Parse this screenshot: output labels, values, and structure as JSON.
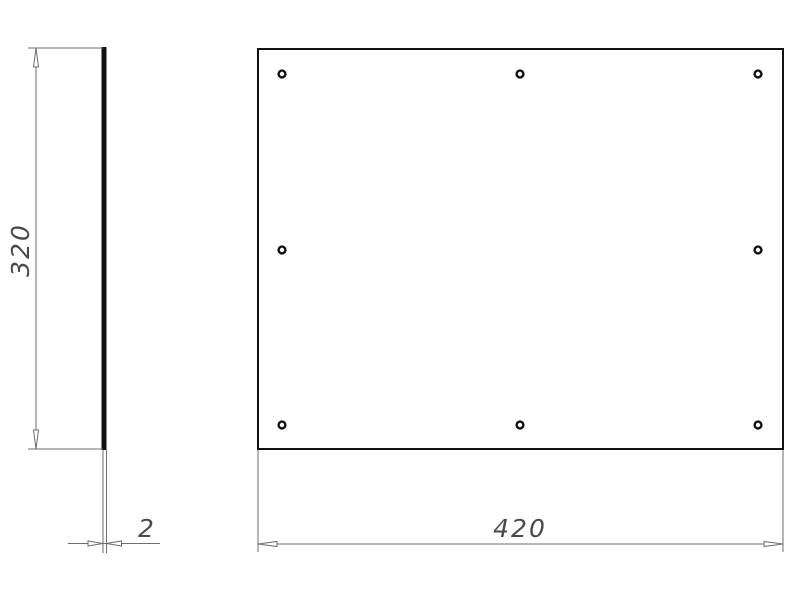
{
  "colors": {
    "background": "#ffffff",
    "outline": "#111111",
    "dim": "#6e6e6e",
    "text": "#4a4a4a"
  },
  "labels": {
    "plate_height": "320",
    "plate_thickness": "2",
    "plate_width": "420"
  },
  "front_view": {
    "hole_count": 8,
    "hole_radius": 3.4,
    "holes": [
      {
        "cx": 282,
        "cy": 74
      },
      {
        "cx": 520,
        "cy": 74
      },
      {
        "cx": 758,
        "cy": 74
      },
      {
        "cx": 282,
        "cy": 250
      },
      {
        "cx": 758,
        "cy": 250
      },
      {
        "cx": 282,
        "cy": 425
      },
      {
        "cx": 520,
        "cy": 425
      },
      {
        "cx": 758,
        "cy": 425
      }
    ]
  }
}
